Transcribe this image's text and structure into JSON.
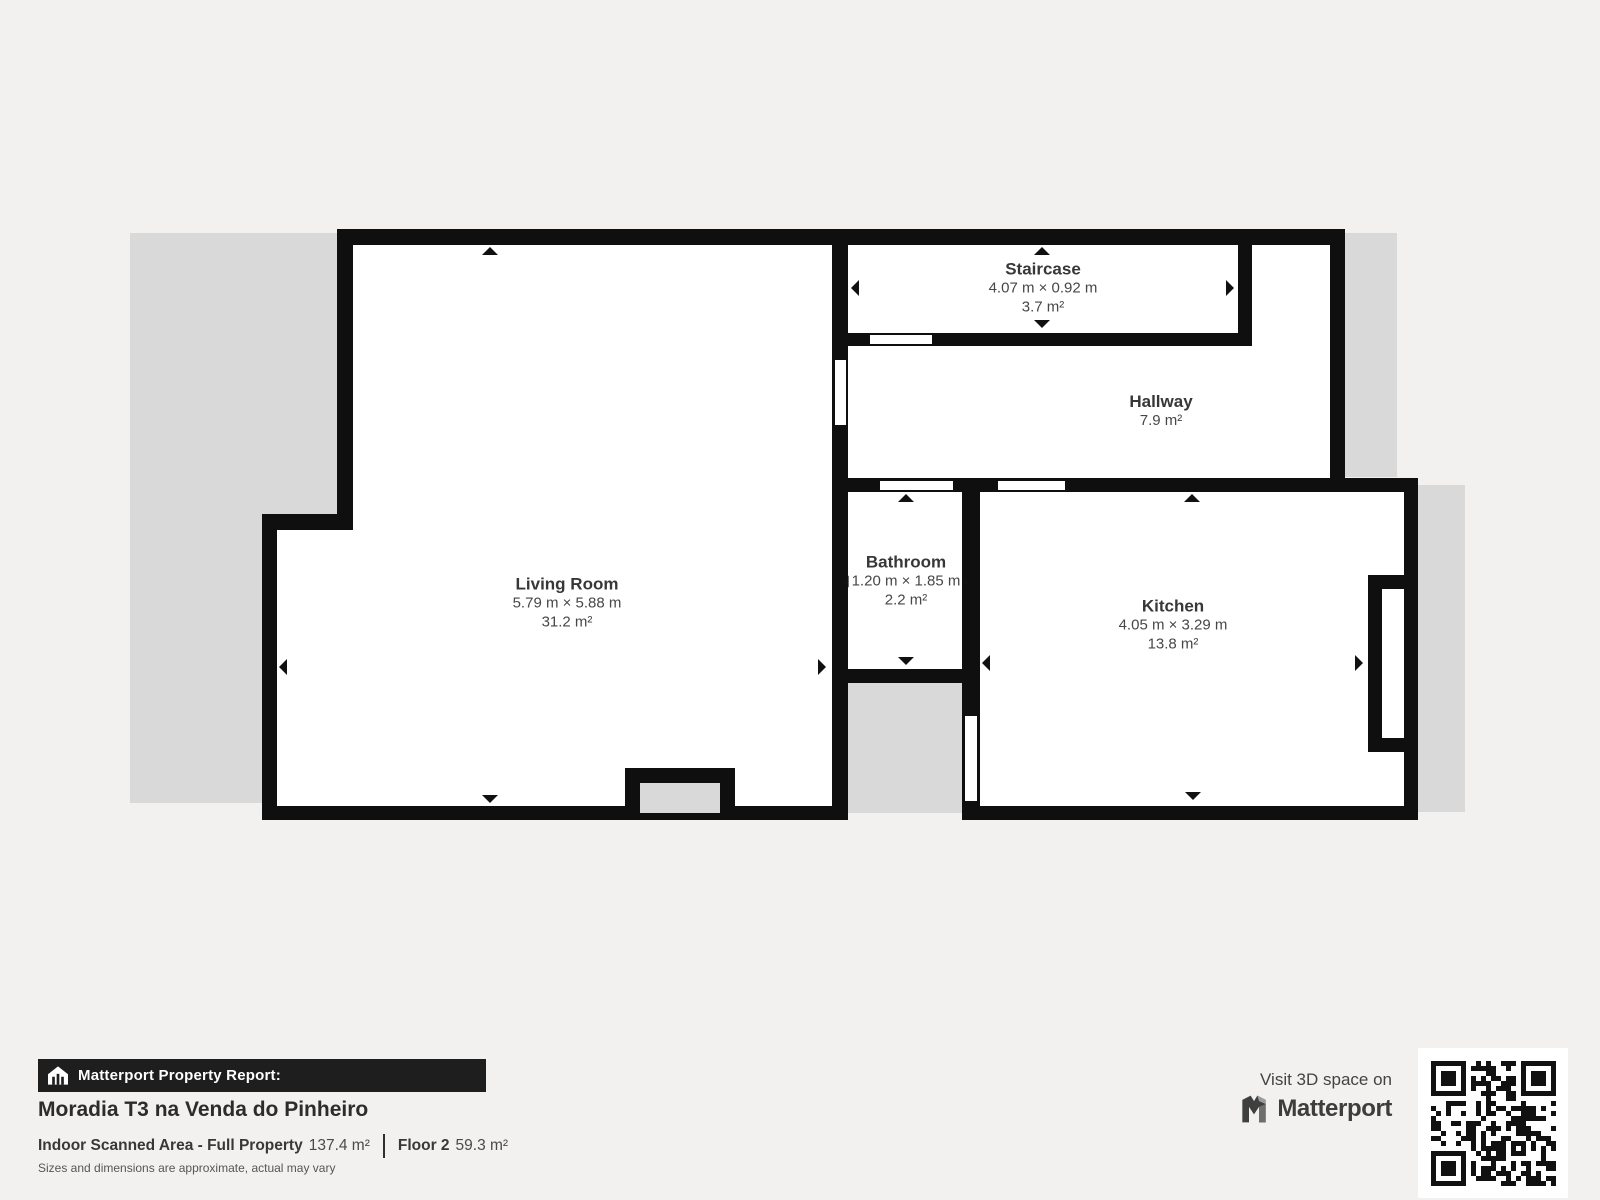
{
  "plan": {
    "colors": {
      "wall": "#0f0f0f",
      "backdrop": "#d9d9d9",
      "room": "#ffffff",
      "page": "#f2f1ef"
    },
    "rooms": [
      {
        "name": "Living Room",
        "dimensions": "5.79 m × 5.88 m",
        "area": "31.2 m²"
      },
      {
        "name": "Staircase",
        "dimensions": "4.07 m × 0.92 m",
        "area": "3.7 m²"
      },
      {
        "name": "Hallway",
        "area": "7.9 m²"
      },
      {
        "name": "Bathroom",
        "dimensions": "1.20 m × 1.85 m",
        "area": "2.2 m²"
      },
      {
        "name": "Kitchen",
        "dimensions": "4.05 m × 3.29 m",
        "area": "13.8 m²"
      }
    ]
  },
  "footer": {
    "report_label": "Matterport Property Report:",
    "property_title": "Moradia T3 na Venda do Pinheiro",
    "scanned_area_label": "Indoor Scanned Area - Full Property",
    "scanned_area_value": "137.4 m²",
    "floor_label": "Floor 2",
    "floor_value": "59.3 m²",
    "disclaimer": "Sizes and dimensions are approximate, actual may vary",
    "cta_text": "Visit 3D space on",
    "brand_name": "Matterport"
  }
}
